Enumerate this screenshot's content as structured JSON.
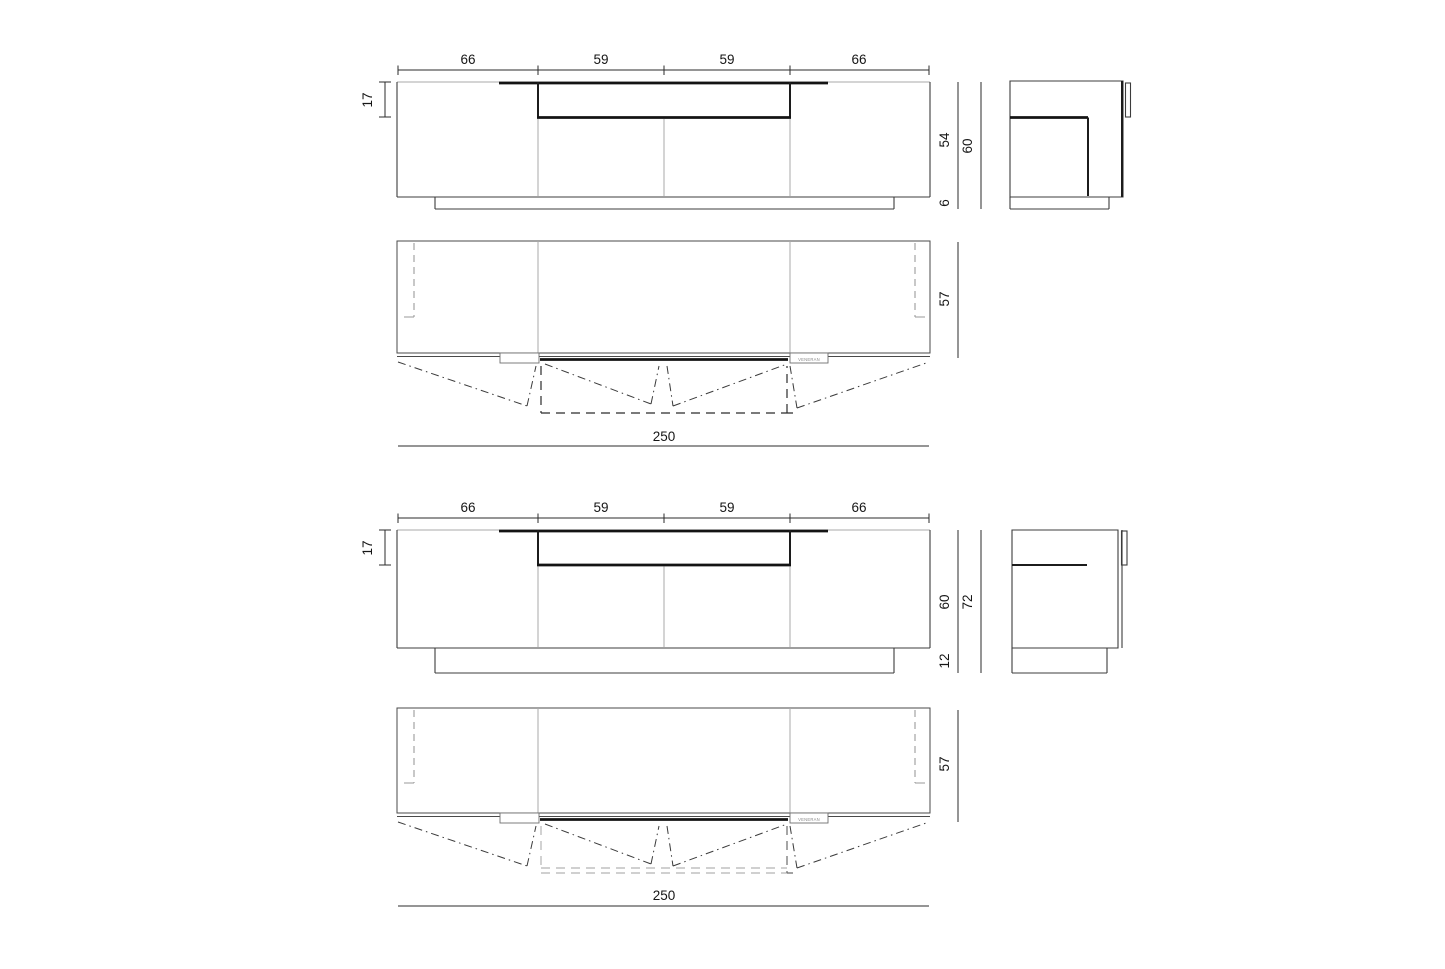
{
  "colors": {
    "outline": "#3c3c3c",
    "light_line": "#a9a9a9",
    "dark_line": "#141414",
    "dimension_text": "#161616",
    "hidden_line": "#9a9a9a",
    "background": "#ffffff"
  },
  "top_variant": {
    "front": {
      "widths": [
        "66",
        "59",
        "59",
        "66"
      ],
      "niche_depth": "17",
      "body_height": "54",
      "plinth_height": "6",
      "total_height": "60"
    },
    "plan": {
      "depth": "57",
      "total_width": "250",
      "brand": "VENERAN"
    }
  },
  "bottom_variant": {
    "front": {
      "widths": [
        "66",
        "59",
        "59",
        "66"
      ],
      "niche_depth": "17",
      "body_height": "60",
      "plinth_height": "12",
      "total_height": "72"
    },
    "plan": {
      "depth": "57",
      "total_width": "250",
      "brand": "VENERAN"
    }
  }
}
